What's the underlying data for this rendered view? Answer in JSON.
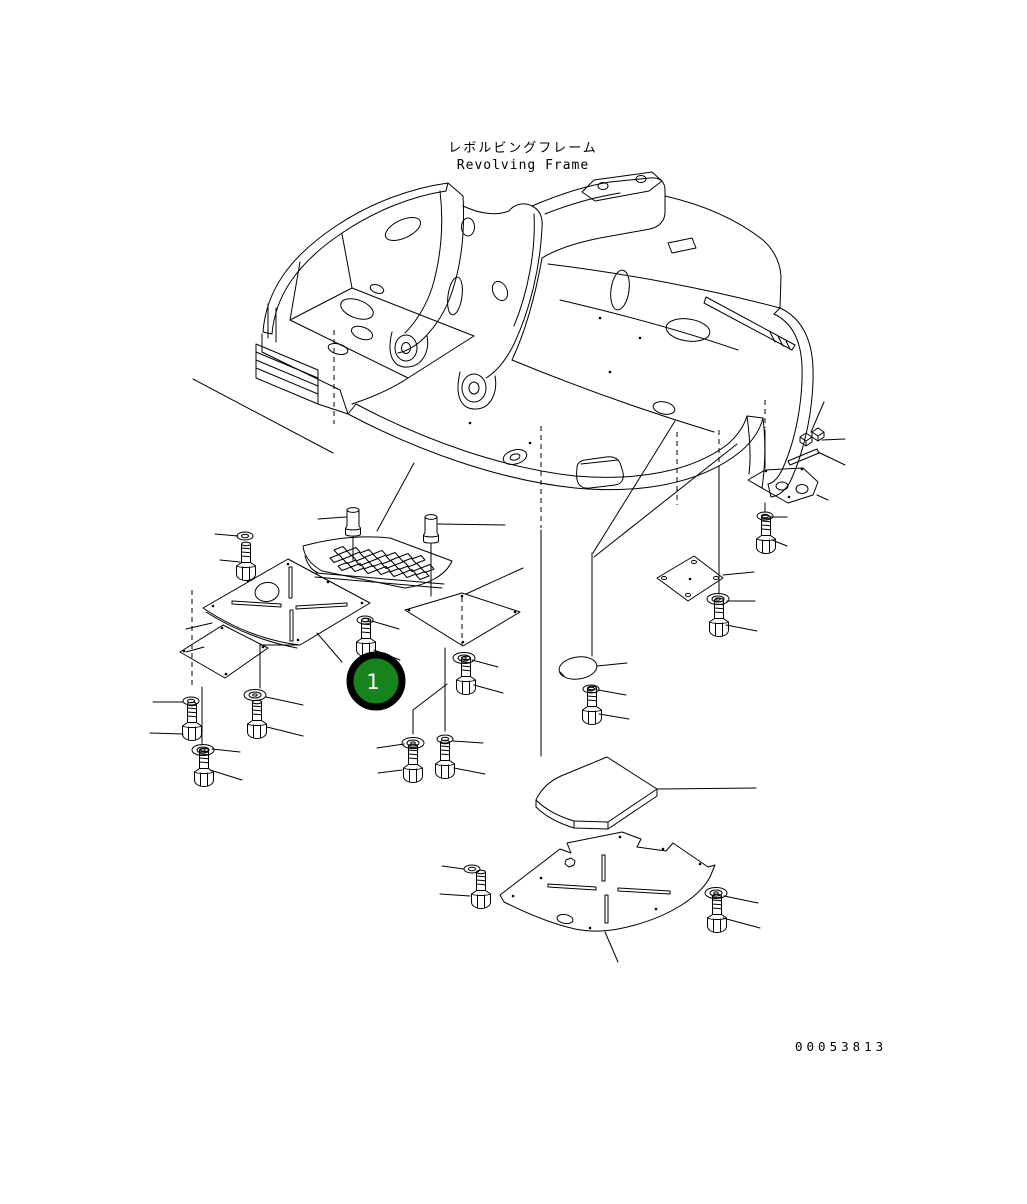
{
  "page": {
    "background_color": "#ffffff",
    "line_color": "#000000"
  },
  "title": {
    "ja": "レボルビングフレーム",
    "en": "Revolving Frame"
  },
  "drawing_number": "00053813",
  "callout": {
    "label": "1",
    "fill_color": "#17831d",
    "ring_color": "#000000",
    "label_color": "#ffffff"
  }
}
